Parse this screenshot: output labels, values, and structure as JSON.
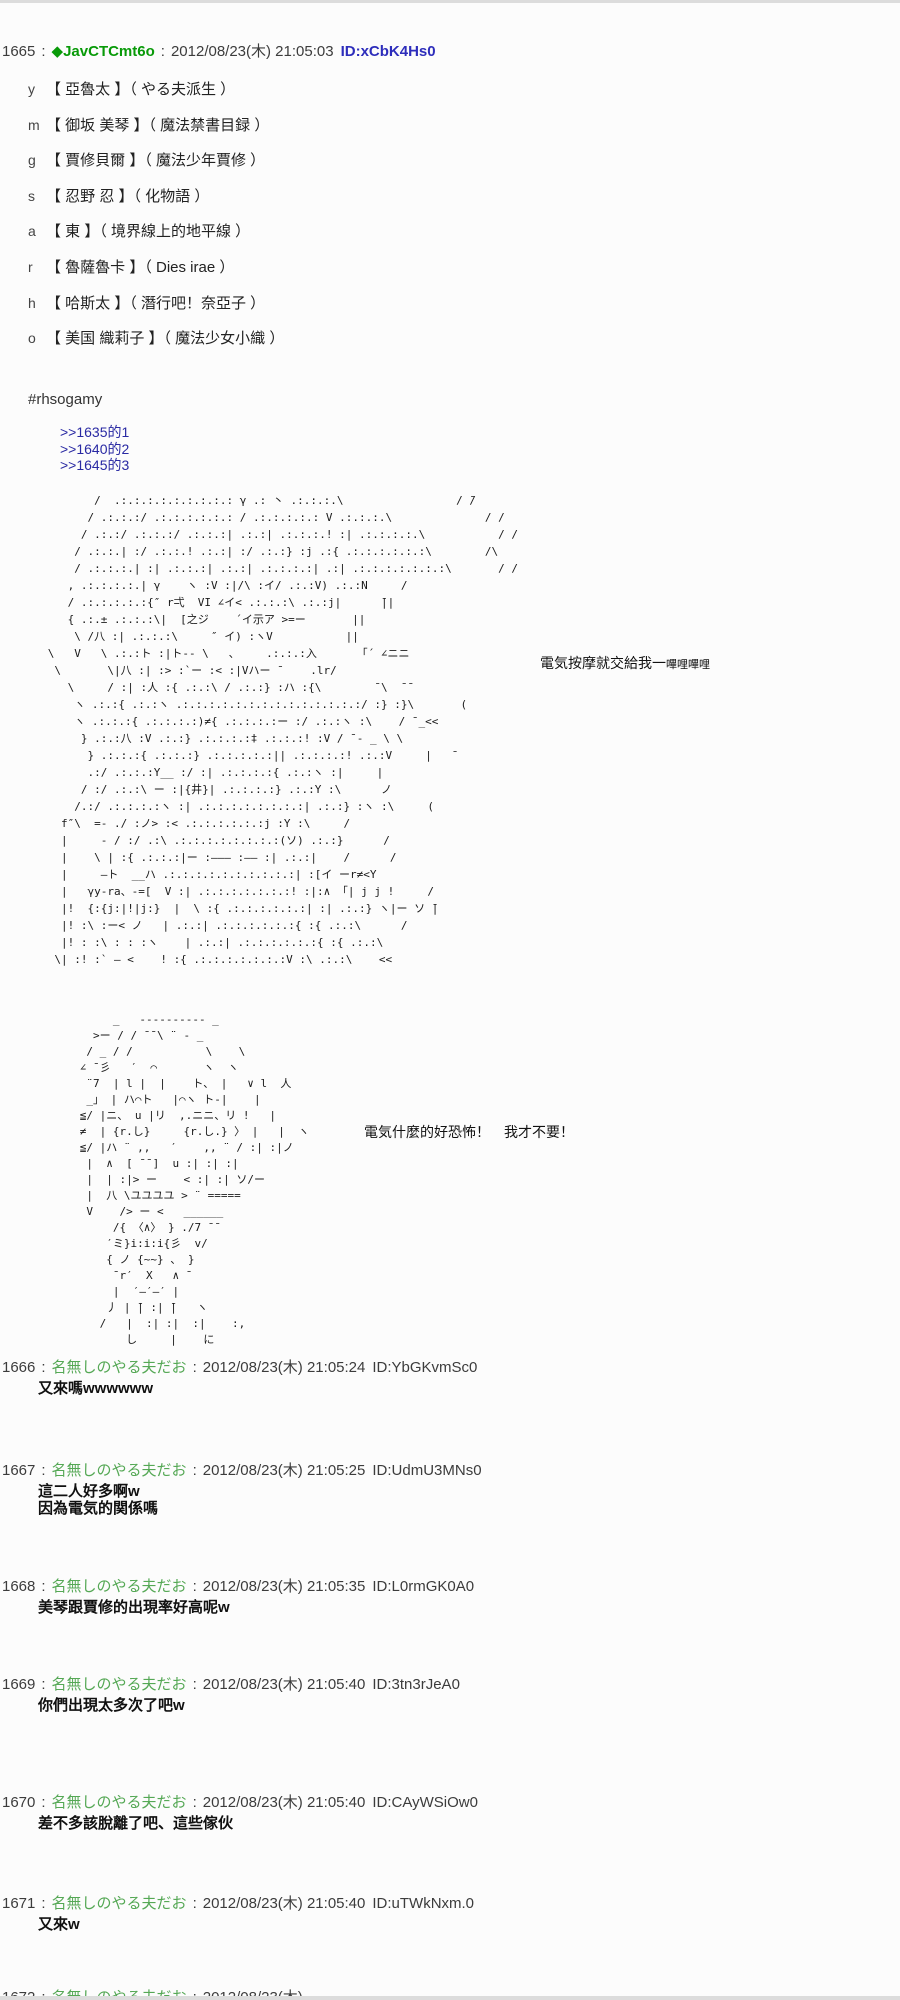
{
  "colors": {
    "trip_name": "#089a08",
    "anon_name": "#55a855",
    "op_id_blue": "#2d2dbb",
    "anchor_link": "#2929a3",
    "background": "#fcfcfc"
  },
  "thread": {
    "sep": ":",
    "op": {
      "number": "1665",
      "name": "◆JavCTCmt6o",
      "date": "2012/08/23(木) 21:05:03",
      "id": "ID:xCbK4Hs0",
      "roster": [
        {
          "key": "y",
          "entry": "【 亞魯太 】（ やる夫派生 ）"
        },
        {
          "key": "m",
          "entry": "【 御坂 美琴 】（ 魔法禁書目録 ）"
        },
        {
          "key": "g",
          "entry": "【 賈修貝爾 】（ 魔法少年賈修 ）"
        },
        {
          "key": "s",
          "entry": "【 忍野 忍 】（ 化物語 ）"
        },
        {
          "key": "a",
          "entry": "【 東 】（ 境界線上的地平線 ）"
        },
        {
          "key": "r",
          "entry": "【 魯薩魯卡 】（ Dies irae ）"
        },
        {
          "key": "h",
          "entry": "【 哈斯太 】（ 潛行吧！奈亞子 ）"
        },
        {
          "key": "o",
          "entry": "【 美国 織莉子 】（ 魔法少女小織 ）"
        }
      ],
      "hashtag": "#rhsogamy",
      "anchors": [
        ">>1635的1",
        ">>1640的2",
        ">>1645的3"
      ],
      "aa1": "             /  .:.:.:.:.:.:.:.:.: γ .: 丶 .:.:.:.\\                 / ̄/\n            / .:.:.:/ .:.:.:.:.:.: / .:.:.:.:.: V .:.:.:.\\              / /\n           / .:.:/ .:.:.:/ .:.:.:| .:.:| .:.:.:.! :| .:.:.:.:.\\           / /\n          / .:.:.| :/ .:.:.! .:.:| :/ .:.:} :j .:{ .:.:.:.:.:.:\\        /\\\n          / .:.:.:.| :| .:.:.:| .:.:| .:.:.:.:| .:| .:.:.:.:.:.:.:\\       / /\n         , .:.:.:.:.| γ    ヽ :V :|/\\ :イ/ .:.:V) .:.:N     /\n         / .:.:.:.:.:{″ r弌  VI ∠イ< .:.:.:\\ .:.:j|      ̄||\n         { .:.± .:.:.:\\|  [之ジ    ´イ示ア >=ー       ||\n          \\ /八 :| .:.:.:\\     ″ イ) :ヽV           ||\n      \\   V   \\ .:.:ト :|ト-- \\   、    .:.:.:入      「´ ∠ニニ\n       \\       \\|八 :| :> :`ー :< :|Vハー ̄     .lr/\n         \\     / :| :人 :{ .:.:\\ / .:.:} :ハ :{\\        ̄ \\  ̄ ̄\n          ヽ .:.:{ .:.:ヽ .:.:.:.:.:.:.:.:.:.:.:.:.:.:/ :} :}\\       (\n          ヽ .:.:.:{ .:.:.:.:)≠{ .:.:.:.:ー :/ .:.:ヽ :\\    / ̄ _<<\n           } .:.:八 :V .:.:} .:.:.:.:‡ .:.:.:! :V / ̄ ‐ _ \\ \\\n            } .:.:.:{ .:.:.:} .:.:.:.:.:|| .:.:.:.:! .:.:V     |   ̄\n            .:/ .:.:.:Y__ :/ :| .:.:.:.:{ .:.:ヽ :|     |\n           / :/ .:.:\\ ー :|{井}| .:.:.:.:} .:.:Y :\\      ノ\n          /.:/ .:.:.:.:ヽ :| .:.:.:.:.:.:.:.:| .:.:} :ヽ :\\     (\n        f″\\  =‐ ./ :ノ> :< .:.:.:.:.:.:j :Y :\\     /\n        |     ‐ / :/ .:\\ .:.:.:.:.:.:.:.:(ソ) .:.:}      /\n        |    \\ | :{ .:.:.:|ー :――― :―― :| .:.:|    /      /\n        |     ―ト  __ハ .:.:.:.:.:.:.:.:.:.:| :[イ ーr≠<Y\n        |   γy-ra、-=[  V :| .:.:.:.:.:.:.:! :|:∧ 「| j j !     /\n        |!  {:{j:|!|j:}  |  \\ :{ .:.:.:.:.:.:| :| .:.:} ヽ|ー ソ ̄|\n        |! :\\ :ー< ノ   | .:.:| .:.:.:.:.:.:{ :{ .:.:\\      /\n        |! : :\\ : : :ヽ    | .:.:| .:.:.:.:.:.:{ :{ .:.:\\\n       \\| :! :` ― <    ! :{ .:.:.:.:.:.:.:V :\\ .:.:\\    <<",
      "aa1_caption_main": "電気按摩就交給我一",
      "aa1_caption_small": "嗶哩嗶哩",
      "aa2": "           _   ---------- _\n        >ー / / ̄ ̄ \\ ¨ - _\n       / _ / /           \\    \\\n      ∠ ̄ 彡   ′  ⌒       ヽ  ヽ\n       ¨7  | l |  |    ト、 |   ∨ l  人\n       _」 | ハ⌒ト   |⌒ヽ ト-|    |\n      ≦/ |ニ、 u |リ  ,.ニニ、リ !   |\n      ≠  | {r.し}     {r.し.} 〉 |   |  ヽ\n      ≦/ |ハ ¨ ,,   ′    ,, ¨ / :| :|ノ\n       |  ∧  [ ̄ ̄ ]  u :| :| :|\n       |  | :|> ー    < :| :| ソ/ー\n       |  八 \\ユユユユ > ¨ =====\n       V    /> ー <   ______\n           /{ 〈∧〉 } ./7 ̄ ̄\n          ′ミ}i:i:i{彡  v/\n          { ノ {~~} 、 }\n           ̄ r′  X   ∧ ̄\n           |  ′―′―′ |\n          丿 | ̄| :| ̄|   ヽ\n         /   |  :| :|  :|    :,\n             し     |    に",
      "aa2_caption": "電気什麼的好恐怖！　我才不要！"
    },
    "replies": [
      {
        "number": "1666",
        "name": "名無しのやる夫だお",
        "date": "2012/08/23(木) 21:05:24",
        "id": "ID:YbGKvmSc0",
        "lines": [
          "又來嗎wwwwww"
        ]
      },
      {
        "number": "1667",
        "name": "名無しのやる夫だお",
        "date": "2012/08/23(木) 21:05:25",
        "id": "ID:UdmU3MNs0",
        "lines": [
          "這二人好多啊w",
          "因為電気的関係嗎"
        ]
      },
      {
        "number": "1668",
        "name": "名無しのやる夫だお",
        "date": "2012/08/23(木) 21:05:35",
        "id": "ID:L0rmGK0A0",
        "lines": [
          "美琴跟賈修的出現率好高呢w"
        ]
      },
      {
        "number": "1669",
        "name": "名無しのやる夫だお",
        "date": "2012/08/23(木) 21:05:40",
        "id": "ID:3tn3rJeA0",
        "lines": [
          "你們出現太多次了吧w"
        ]
      },
      {
        "number": "1670",
        "name": "名無しのやる夫だお",
        "date": "2012/08/23(木) 21:05:40",
        "id": "ID:CAyWSiOw0",
        "lines": [
          "差不多該脫離了吧、這些傢伙"
        ]
      },
      {
        "number": "1671",
        "name": "名無しのやる夫だお",
        "date": "2012/08/23(木) 21:05:40",
        "id": "ID:uTWkNxm.0",
        "lines": [
          "又來w"
        ]
      },
      {
        "number": "1672",
        "name": "名無しのやる夫だお",
        "date": "2012/08/23(木)",
        "id": "",
        "lines": []
      }
    ]
  }
}
